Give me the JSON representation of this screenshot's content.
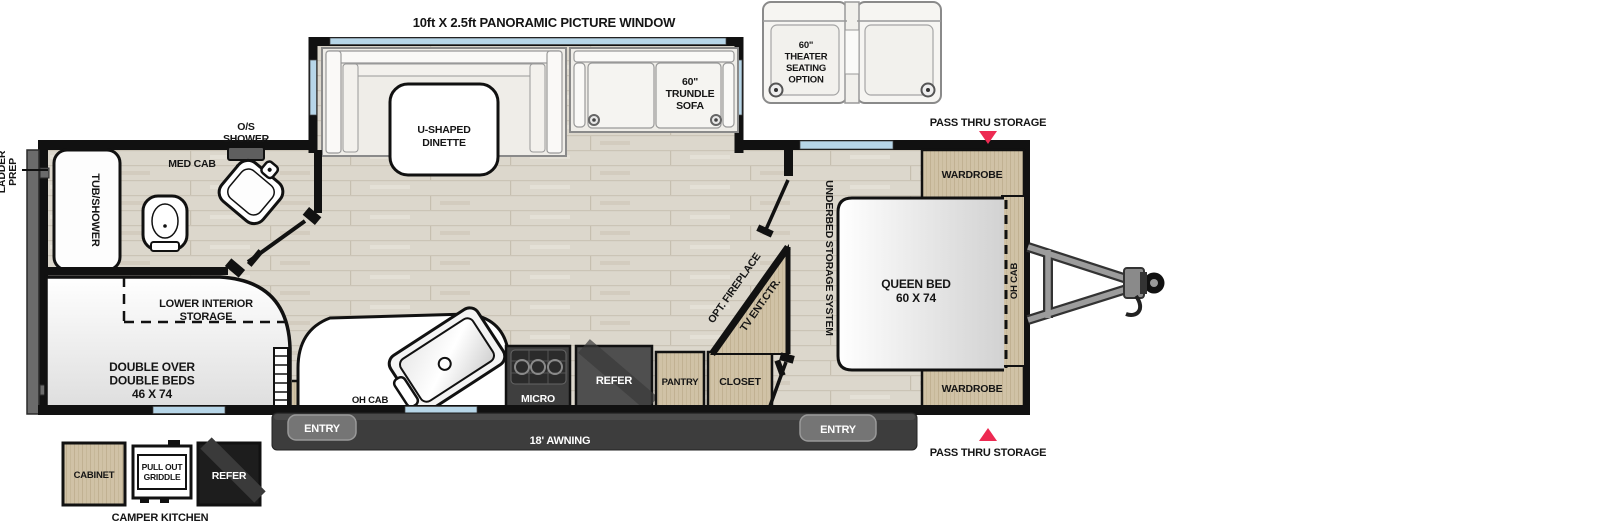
{
  "plan": {
    "window_label": "10ft X 2.5ft PANORAMIC PICTURE WINDOW",
    "slideout": {
      "dinette_line1": "U-SHAPED",
      "dinette_line2": "DINETTE",
      "trundle_line1": "60\"",
      "trundle_line2": "TRUNDLE",
      "trundle_line3": "SOFA"
    },
    "theater": {
      "line1": "60\"",
      "line2": "THEATER",
      "line3": "SEATING",
      "line4": "OPTION"
    },
    "storage": {
      "pass_thru_top": "PASS THRU STORAGE",
      "pass_thru_bottom": "PASS THRU STORAGE",
      "underbed": "UNDERBED STORAGE SYSTEM",
      "lower_interior_line1": "LOWER INTERIOR",
      "lower_interior_line2": "STORAGE"
    },
    "bedroom": {
      "wardrobe_top": "WARDROBE",
      "wardrobe_bottom": "WARDROBE",
      "queen_line1": "QUEEN BED",
      "queen_line2": "60 X 74",
      "oh_cab": "OH CAB"
    },
    "bath": {
      "os_shower_line1": "O/S",
      "os_shower_line2": "SHOWER",
      "med_cab": "MED CAB",
      "tub_shower": "TUB/SHOWER"
    },
    "bunk": {
      "beds_line1": "DOUBLE OVER",
      "beds_line2": "DOUBLE BEDS",
      "beds_line3": "46 X 74",
      "ladder": "LADDER",
      "ladder_prep_line1": "LADDER",
      "ladder_prep_line2": "PREP"
    },
    "kitchen": {
      "oh_cab": "OH CAB",
      "micro": "MICRO",
      "refer": "REFER",
      "pantry": "PANTRY",
      "closet": "CLOSET"
    },
    "hall": {
      "fireplace": "OPT. FIREPLACE",
      "tv_center": "TV ENT.CTR."
    },
    "exterior": {
      "entry_left": "ENTRY",
      "entry_right": "ENTRY",
      "awning": "18' AWNING",
      "camper_cabinet": "CABINET",
      "camper_griddle_line1": "PULL OUT",
      "camper_griddle_line2": "GRIDDLE",
      "camper_refer": "REFER",
      "camper_kitchen": "CAMPER KITCHEN"
    }
  },
  "colors": {
    "arrow_red": "#ed2a52",
    "window_blue": "#b7d6e8",
    "floor_base": "#dcd7cc",
    "wood_base": "#d0c2a6",
    "wall_black": "#111111",
    "appliance_dark": "#4a4a4a",
    "awning_bar": "#3d3d3d"
  }
}
